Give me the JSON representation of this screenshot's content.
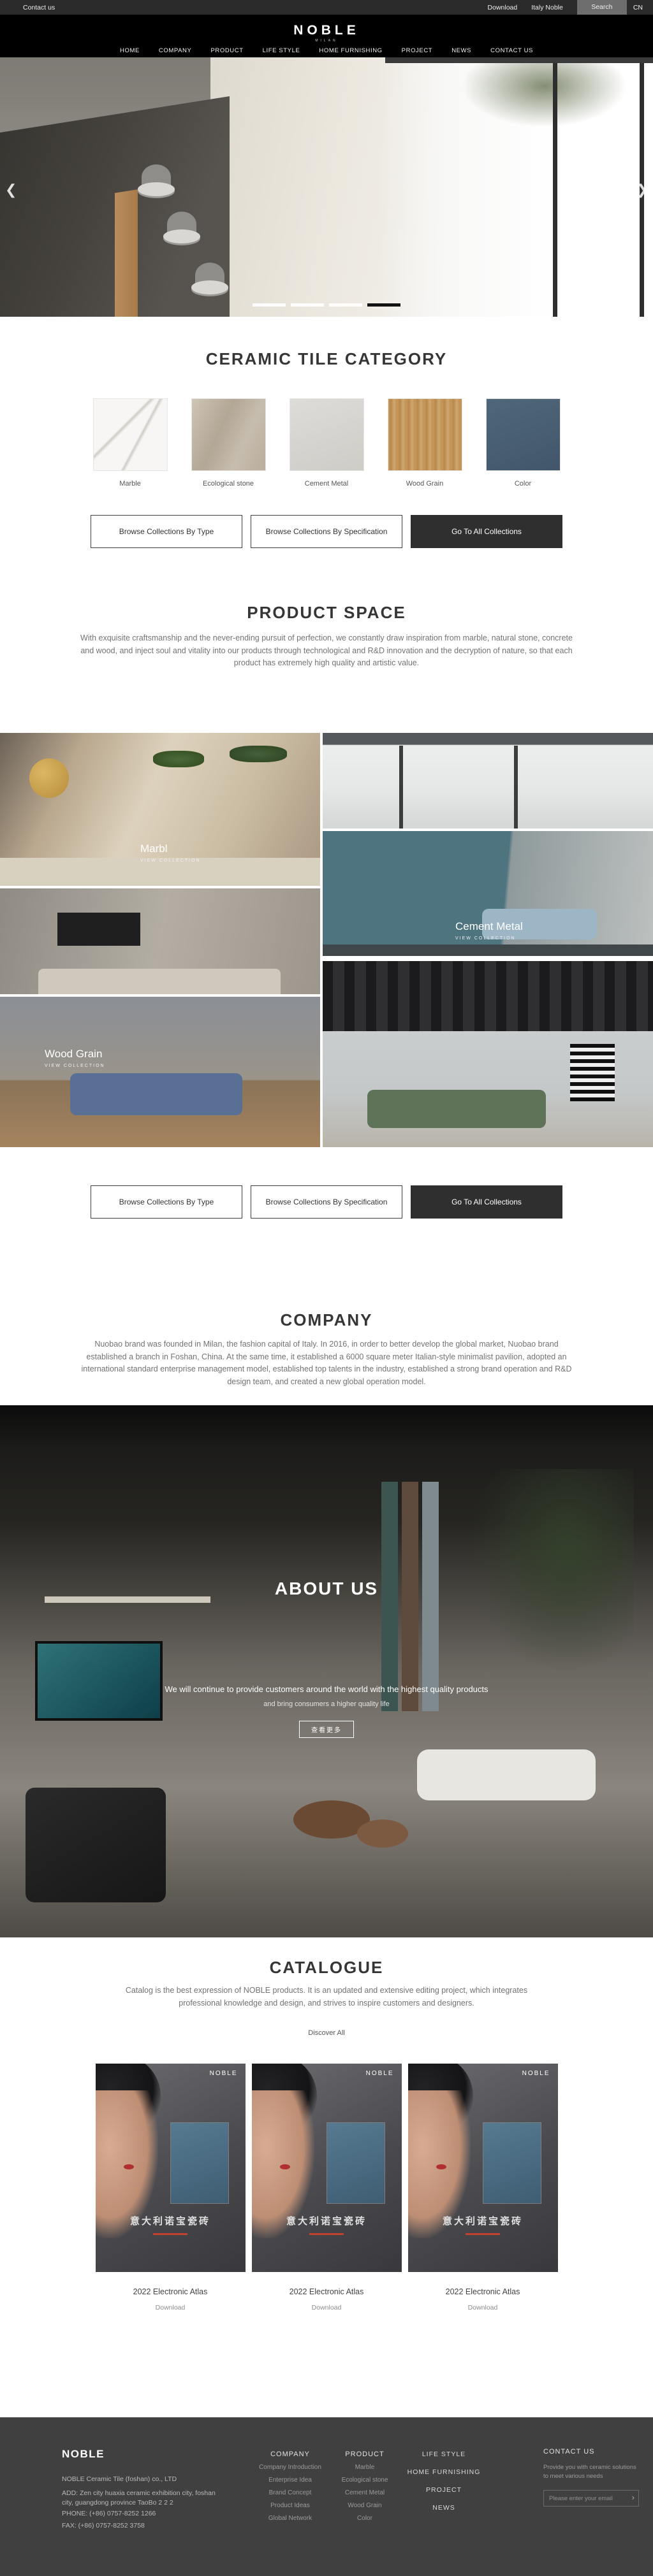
{
  "topbar": {
    "contact": "Contact us",
    "download": "Download",
    "italy": "Italy Noble",
    "search": "Search",
    "lang": "CN"
  },
  "header": {
    "logo": "NOBLE",
    "logo_sub": "MILAN",
    "nav": [
      "HOME",
      "COMPANY",
      "PRODUCT",
      "LIFE STYLE",
      "HOME FURNISHING",
      "PROJECT",
      "NEWS",
      "CONTACT US"
    ]
  },
  "hero": {
    "prev_icon": "❮",
    "next_icon": "❯"
  },
  "category": {
    "title": "CERAMIC TILE CATEGORY",
    "items": [
      {
        "label": "Marble"
      },
      {
        "label": "Ecological stone"
      },
      {
        "label": "Cement Metal"
      },
      {
        "label": "Wood Grain"
      },
      {
        "label": "Color"
      }
    ]
  },
  "buttons": {
    "by_type": "Browse Collections By Type",
    "by_spec": "Browse Collections By Specification",
    "all": "Go To All Collections"
  },
  "product_space": {
    "title": "PRODUCT SPACE",
    "description": "With exquisite craftsmanship and the never-ending pursuit of perfection, we constantly draw inspiration from marble, natural stone, concrete and wood, and inject soul and vitality into our products through technological and R&D innovation and the decryption of nature, so that each product has extremely high quality and artistic value.",
    "tiles": [
      {
        "label": "Marbl",
        "sub": "VIEW COLLECTION"
      },
      {
        "label": "Cement Metal",
        "sub": "VIEW COLLECTION"
      },
      {
        "label": "Wood Grain",
        "sub": "VIEW COLLECTION"
      }
    ]
  },
  "company": {
    "title": "COMPANY",
    "description": "Nuobao brand was founded in Milan, the fashion capital of Italy. In 2016, in order to better develop the global market, Nuobao brand established a branch in Foshan, China. At the same time, it established a 6000 square meter Italian-style minimalist pavilion, adopted an international standard enterprise management model, established top talents in the industry, established a strong brand operation and R&D design team, and created a new global operation model."
  },
  "about": {
    "title": "ABOUT US",
    "line1": "We will continue to provide customers around the world with the highest quality products",
    "line2": "and bring consumers a higher quality life",
    "more": "查看更多"
  },
  "catalogue": {
    "title": "CATALOGUE",
    "description": "Catalog is the best expression of NOBLE products. It is an updated and extensive editing project, which integrates professional knowledge and design, and strives to inspire customers and designers.",
    "discover": "Discover All",
    "cover": {
      "brand": "NOBLE",
      "cn": "意大利诺宝瓷砖"
    },
    "items": [
      {
        "title": "2022 Electronic Atlas",
        "action": "Download"
      },
      {
        "title": "2022 Electronic Atlas",
        "action": "Download"
      },
      {
        "title": "2022 Electronic Atlas",
        "action": "Download"
      }
    ]
  },
  "footer": {
    "brand": "NOBLE",
    "company_line": "NOBLE Ceramic Tile (foshan) co., LTD",
    "address": "ADD:  Zen city huaxia ceramic exhibition city, foshan city, guangdong province TaoBo 2 2 2",
    "phone": "PHONE:   (+86)  0757-8252 1266",
    "fax": "FAX:   (+86)  0757-8252 3758",
    "cols": [
      {
        "title": "COMPANY",
        "items": [
          "Company Introduction",
          "Enterprise Idea",
          "Brand Concept",
          "Product Ideas",
          "Global Network"
        ]
      },
      {
        "title": "PRODUCT",
        "items": [
          "Marble",
          "Ecological stone",
          "Cement Metal",
          "Wood Grain",
          "Color"
        ]
      }
    ],
    "links": [
      "LIFE STYLE",
      "HOME FURNISHING",
      "PROJECT",
      "NEWS"
    ],
    "contact": {
      "title": "CONTACT US",
      "blurb": "Provide you with ceramic solutions to meet various needs",
      "placeholder": "Please enter your email",
      "send_icon": "›"
    }
  }
}
